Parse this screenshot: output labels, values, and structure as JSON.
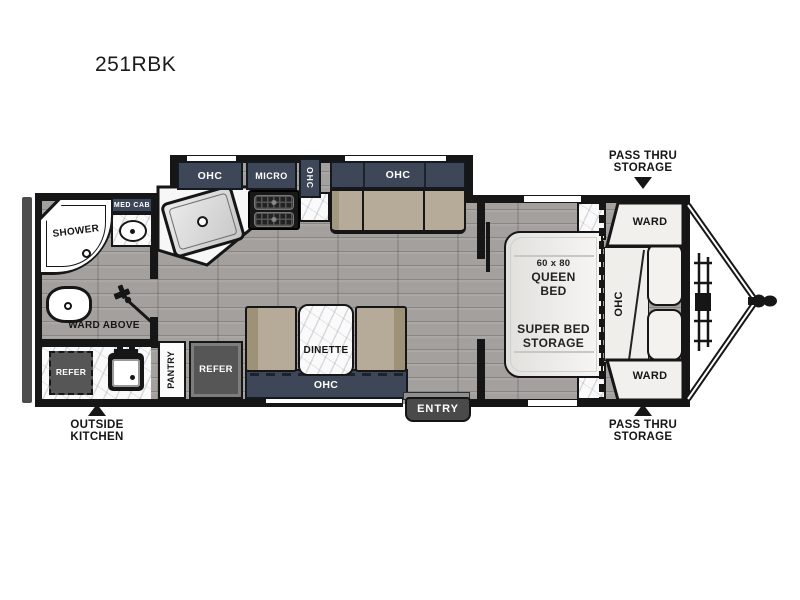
{
  "title": "251RBK",
  "colors": {
    "wall": "#161616",
    "cabinet_navy": "#3d4757",
    "cushion_tan": "#b4a996",
    "floor_gray": "#a3a09d",
    "marble": "#fafafa",
    "compartment_gray": "#565656",
    "entry_badge_gray": "#4a4a4a"
  },
  "floorplan": {
    "bathroom": {
      "shower": "SHOWER",
      "med_cab": "MED CAB",
      "ward_above": "WARD ABOVE"
    },
    "outside_kitchen": {
      "refer": "REFER",
      "label_line1": "OUTSIDE",
      "label_line2": "KITCHEN"
    },
    "kitchen": {
      "ohc": "OHC",
      "micro": "MICRO",
      "ohc_side": "OHC"
    },
    "sofa": {
      "ohc": "OHC"
    },
    "dinette": {
      "pantry": "PANTRY",
      "refer": "REFER",
      "label": "DINETTE",
      "ohc": "OHC"
    },
    "entry": {
      "label": "ENTRY"
    },
    "bedroom": {
      "bed_size": "60 x 80",
      "bed_line1": "QUEEN",
      "bed_line2": "BED",
      "storage_line1": "SUPER BED",
      "storage_line2": "STORAGE",
      "ohc": "OHC",
      "ward_front_top": "WARD",
      "ward_front_bottom": "WARD"
    },
    "callouts": {
      "pass_thru_top_line1": "PASS THRU",
      "pass_thru_top_line2": "STORAGE",
      "pass_thru_bottom_line1": "PASS THRU",
      "pass_thru_bottom_line2": "STORAGE"
    }
  }
}
